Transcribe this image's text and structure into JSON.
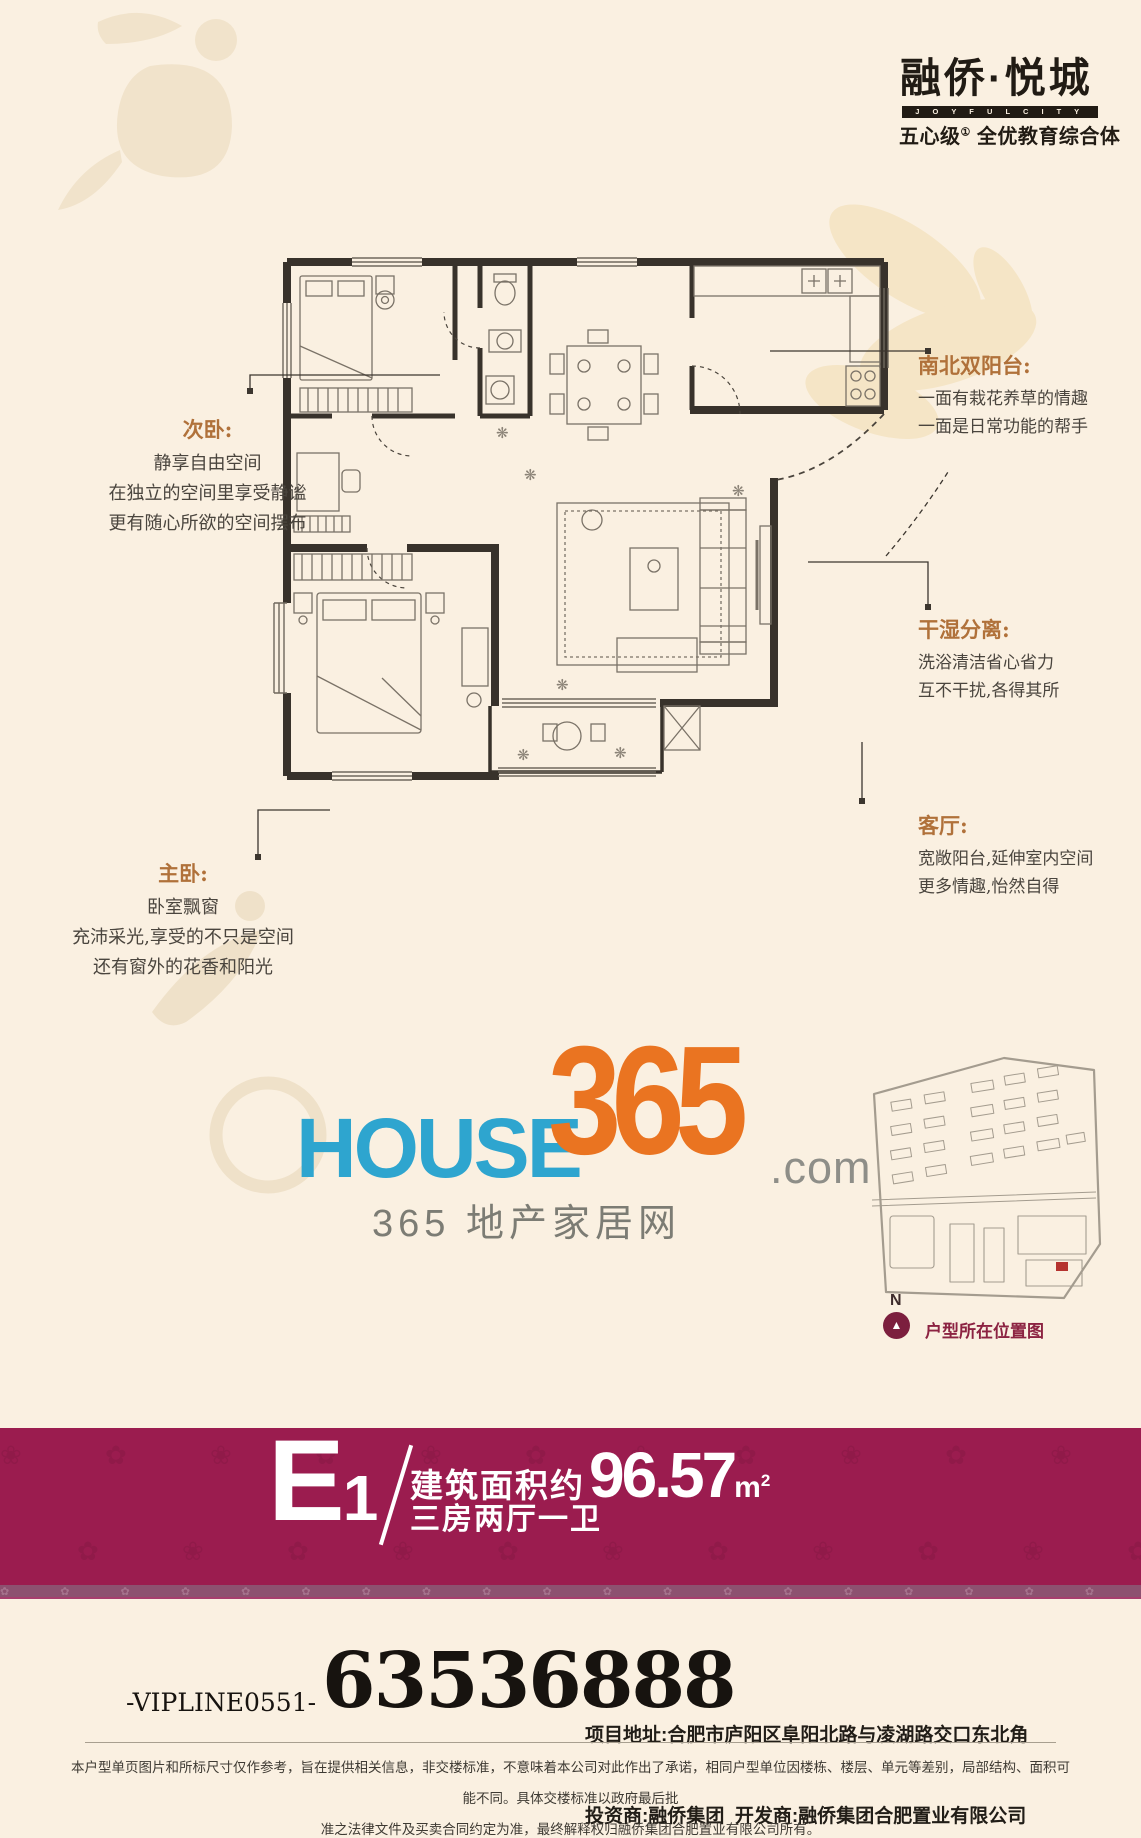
{
  "brand": {
    "name_cn": "融侨·悦城",
    "name_en": "J O Y F U L  C I T Y",
    "tagline_prefix": "五心级",
    "tagline_sup": "①",
    "tagline_suffix": " 全优教育综合体"
  },
  "callouts": {
    "secondary_bedroom": {
      "title": "次卧:",
      "line1": "静享自由空间",
      "line2": "在独立的空间里享受静谧",
      "line3": "更有随心所欲的空间摆布"
    },
    "north_south_balcony": {
      "title": "南北双阳台:",
      "line1": "一面有栽花养草的情趣",
      "line2": "一面是日常功能的帮手"
    },
    "dry_wet_separation": {
      "title": "干湿分离:",
      "line1": "洗浴清洁省心省力",
      "line2": "互不干扰,各得其所"
    },
    "living_room": {
      "title": "客厅:",
      "line1": "宽敞阳台,延伸室内空间",
      "line2": "更多情趣,怡然自得"
    },
    "master_bedroom": {
      "title": "主卧:",
      "line1": "卧室飘窗",
      "line2": "充沛采光,享受的不只是空间",
      "line3": "还有窗外的花香和阳光"
    }
  },
  "media_logo": {
    "house": "HOUSE",
    "num": "365",
    "dotcom": ".com",
    "subtitle": "365 地产家居网"
  },
  "location_map": {
    "compass_letter": "N",
    "compass_arrow": "▲",
    "caption": "户型所在位置图"
  },
  "unit_band": {
    "unit_letter": "E",
    "unit_number": "1",
    "area_label": "建筑面积约",
    "area_value": "96.57",
    "area_unit": "m",
    "area_unit_sup": "2",
    "layout": "三房两厅一卫",
    "pattern_glyphs": "❀ ✿ ❀ ✿ ❀ ✿ ❀ ✿ ❀ ✿ ❀ ✿ ❀ ✿ ❀ ✿ ❀ ✿ ❀",
    "strip_glyphs": "✿ ✿ ✿ ✿ ✿ ✿ ✿ ✿ ✿ ✿ ✿ ✿ ✿ ✿ ✿ ✿ ✿ ✿ ✿ ✿ ✿ ✿ ✿ ✿ ✿ ✿ ✿ ✿ ✿ ✿"
  },
  "contact": {
    "vip_line": "-VIPLINE0551-",
    "phone": "63536888",
    "address_line": "项目地址:合肥市庐阳区阜阳北路与凌湖路交口东北角",
    "company_line": "投资商:融侨集团  开发商:融侨集团合肥置业有限公司"
  },
  "disclaimer": {
    "line1": "本户型单页图片和所标尺寸仅作参考，旨在提供相关信息，非交楼标准，不意味着本公司对此作出了承诺，相同户型单位因楼栋、楼层、单元等差别，局部结构、面积可能不同。具体交楼标准以政府最后批",
    "line2": "准之法律文件及买卖合同约定为准，最终解释权归融侨集团合肥置业有限公司所有。"
  },
  "colors": {
    "background": "#FAF0E1",
    "band": "#9B1C4F",
    "band_strip": "#8D5170",
    "logo_blue": "#2EA5CF",
    "logo_orange": "#EA7421",
    "callout_heading": "#B0713A",
    "callout_body": "#4A453E",
    "caption_red": "#8C2342",
    "compass_red": "#7C1F3E",
    "plan_wall": "#38322B"
  }
}
